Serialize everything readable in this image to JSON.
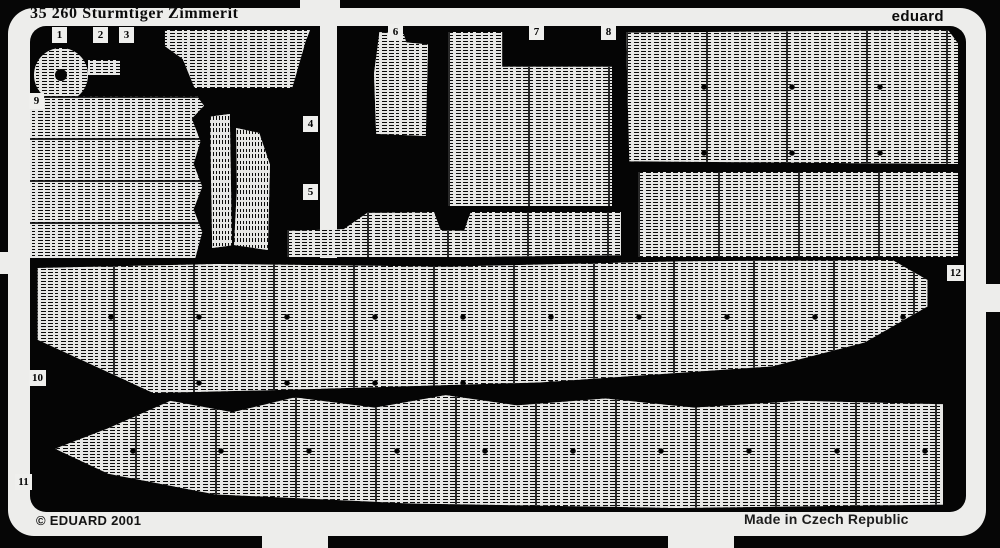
{
  "photo": {
    "title": "35 260 Sturmtiger Zimmerit",
    "brand": "eduard",
    "copyright": "© EDUARD 2001",
    "origin": "Made in Czech Republic"
  },
  "part_tags": [
    {
      "label": "1"
    },
    {
      "label": "2"
    },
    {
      "label": "3"
    },
    {
      "label": "4"
    },
    {
      "label": "5"
    },
    {
      "label": "6"
    },
    {
      "label": "7"
    },
    {
      "label": "8"
    },
    {
      "label": "9"
    },
    {
      "label": "10"
    },
    {
      "label": "11"
    },
    {
      "label": "12"
    }
  ],
  "colors": {
    "background": "#060606",
    "frame": "#ededeb",
    "texture_base": "#e7e7e5",
    "ink": "#0a0a0a"
  }
}
